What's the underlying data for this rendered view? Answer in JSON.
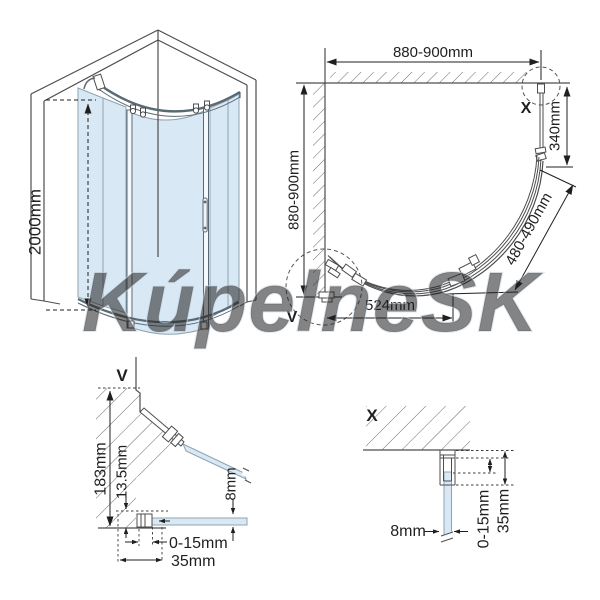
{
  "watermark": {
    "text": "KúpelneSK"
  },
  "front_view": {
    "height_label": "2000mm"
  },
  "plan_view": {
    "width_label": "880-900mm",
    "depth_label": "880-900mm",
    "side_label": "340mm",
    "radius_label": "480-490mm",
    "chord_label": "524mm",
    "marker_x": "X",
    "marker_v": "V"
  },
  "detail_v": {
    "title": "V",
    "dim_183": "183mm",
    "dim_13_5": "13.5mm",
    "dim_8": "8mm",
    "dim_0_15": "0-15mm",
    "dim_35": "35mm"
  },
  "detail_x": {
    "title": "X",
    "dim_8": "8mm",
    "dim_0_15": "0-15mm",
    "dim_35": "35mm"
  },
  "colors": {
    "glass": "#d9e8f5",
    "line": "#4d4d4d",
    "dim_text": "#1f1f1f",
    "watermark_stroke": "#c9d6e2"
  }
}
